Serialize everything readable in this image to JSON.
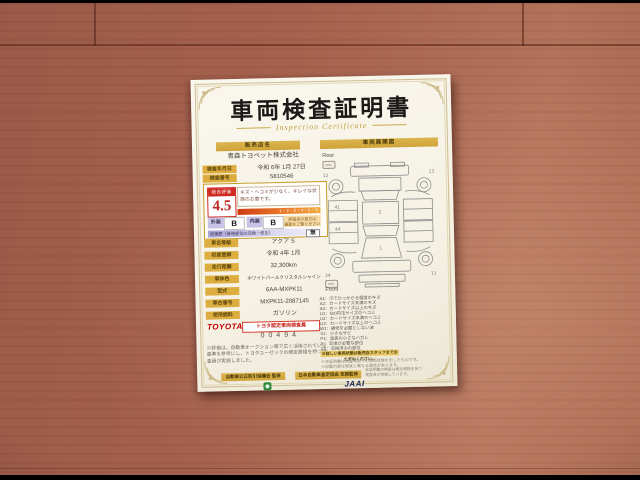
{
  "title": "車両検査証明書",
  "subtitle": "Inspection Certificate",
  "left": {
    "dealer_header": "販売店名",
    "dealer_name": "青森トヨペット株式会社",
    "inspection_date_label": "検査年月日",
    "inspection_date": "令和 6年 1月 27日",
    "cert_no_label": "検査番号",
    "cert_no": "5810546",
    "evaluation": {
      "label": "総合評価",
      "score": "4.5",
      "comment": "キズ・ヘコミが少なく、キレイな状態のお車です。",
      "scale_text": "1・2・3・4・5・S",
      "exterior_label": "外装",
      "exterior": "B",
      "interior_label": "内装",
      "interior": "B",
      "note_line1": "評価点の見方は",
      "note_line2": "裏面をご覧ください",
      "repair_label": "修復歴（骨格部位の交換・修正）",
      "repair_value": "無"
    },
    "rows": [
      {
        "label": "車名等級",
        "value": "アクア S"
      },
      {
        "label": "初度登録",
        "value": "令和 4年 1月"
      },
      {
        "label": "走行距離",
        "value": "32,300km"
      },
      {
        "label": "車体色",
        "value": "ホワイトパールクリスタルシャイン"
      },
      {
        "label": "型式",
        "value": "6AA-MXPK11"
      },
      {
        "label": "車台番号",
        "value": "MXPK11-2087145"
      },
      {
        "label": "使用燃料",
        "value": "ガソリン"
      }
    ],
    "inspector_badge": "トヨタ認定車両検査員",
    "brand": "TOYOTA",
    "inspector_no": "00494",
    "disclaimer": "※評価は、自動車オークション等で広く活用されている基準を参考にし、トヨタユーゼックの検定資格を持つ検査員が実施しました。",
    "footer_left": "自動車公正取引協議会 監修"
  },
  "right": {
    "header": "車両展開図",
    "rear_label": "Rear",
    "front_label": "Front",
    "diagram": {
      "marks": [
        "13",
        "12",
        "41",
        "44",
        "1",
        "2",
        "34",
        "11"
      ]
    },
    "legend": [
      "A1：爪でひっかかる程度のキズ",
      "A2：カードサイズ未満のキズ",
      "A3：カードサイズ以上のキズ",
      "U1：500円玉サイズのヘコミ",
      "U2：カードサイズ未満のヘコミ",
      "U3：カードサイズ以上のヘコミ",
      "W1：補修を必要としない波",
      "S1：小さなサビ",
      "P1：塗装の小さなハガレ",
      "X ：交換が必要な部位",
      "XX：交換済みの部位"
    ],
    "highlight_note": "※詳しい車両状態は販売店スタッフまでおたずねください。",
    "note_line1": "※本証明書は検査時点での車両状態を示したものです。",
    "note_line2": "※記載内容は現状と異なる場合があります。",
    "footer_right": "日本自動車査定協会 定期監修",
    "jaai_logo": "JAAI",
    "jaai_note": "本証明書の検査は検定資格を持つ検査員が実施しています。"
  }
}
